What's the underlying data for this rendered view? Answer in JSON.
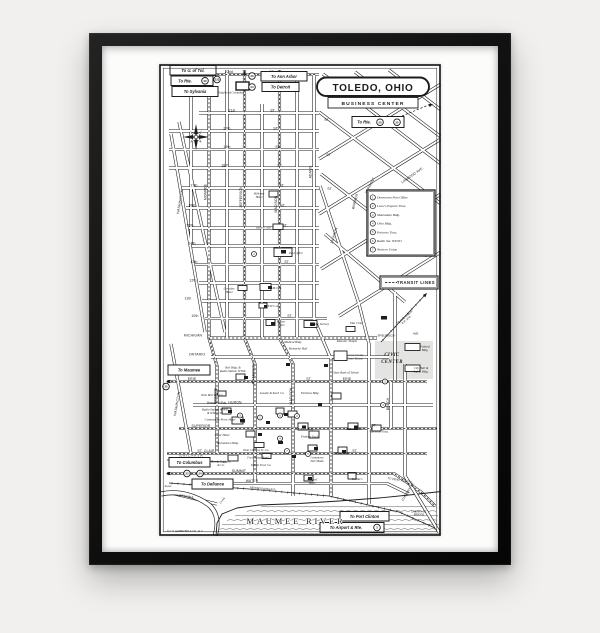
{
  "scene": {
    "background_color": "#f1f0ee",
    "frame_color": "#141414",
    "mat_color": "#fcfcfb",
    "paper_color": "#ffffff",
    "ink_color": "#1c1c1c",
    "civic_fill": "#e4e4e2"
  },
  "map": {
    "title": "TOLEDO, OHIO",
    "subtitle": "BUSINESS CENTER",
    "copyright": "© C.S. HAMMOND & CO., N.Y.",
    "river_label": "MAUMEE RIVER",
    "transit_label": "TRANSIT LINES",
    "legend": {
      "items": [
        {
          "n": "1",
          "label": "Downtown Post Office"
        },
        {
          "n": "2",
          "label": "Loew's Esquire Thea."
        },
        {
          "n": "3",
          "label": "Manhattan Bldg."
        },
        {
          "n": "4",
          "label": "Ohio Bldg."
        },
        {
          "n": "5",
          "label": "Princess Thea."
        },
        {
          "n": "6",
          "label": "Radio Sta. WTOD"
        },
        {
          "n": "7",
          "label": "Western Union"
        }
      ]
    },
    "direction_boxes": [
      {
        "label": "To U. of Tol.",
        "x": 11,
        "y": 1.5,
        "w": 46,
        "h": 9.5
      },
      {
        "label": "To Rte.",
        "x": 12,
        "y": 12,
        "w": 42,
        "h": 9.5,
        "tx": -7
      },
      {
        "label": "To Sylvania",
        "x": 13,
        "y": 22.5,
        "w": 46,
        "h": 10
      },
      {
        "label": "To Ann Arbor",
        "x": 102,
        "y": 7.5,
        "w": 46,
        "h": 9.5
      },
      {
        "label": "To Detroit",
        "x": 103,
        "y": 18.5,
        "w": 37,
        "h": 9
      },
      {
        "label": "To Rte.",
        "x": 193,
        "y": 52.5,
        "w": 52,
        "h": 11,
        "tx": -14
      },
      {
        "label": "To Maumee",
        "x": 9,
        "y": 301,
        "w": 42,
        "h": 10
      },
      {
        "label": "To Columbus",
        "x": 10,
        "y": 393.5,
        "w": 41,
        "h": 9.5
      },
      {
        "label": "To Defiance",
        "x": 33,
        "y": 415,
        "w": 41,
        "h": 10
      },
      {
        "label": "To Port Clinton",
        "x": 181,
        "y": 447.5,
        "w": 49,
        "h": 9.5
      },
      {
        "label": "To Airport & Rte.",
        "x": 161,
        "y": 458.5,
        "w": 64,
        "h": 10,
        "tx": -6
      }
    ],
    "route_shields": [
      {
        "n": "20",
        "x": 46,
        "y": 16.8
      },
      {
        "n": "223",
        "x": 58,
        "y": 15.5
      },
      {
        "n": "23",
        "x": 93,
        "y": 12
      },
      {
        "n": "24",
        "x": 93,
        "y": 23
      },
      {
        "n": "20",
        "x": 221,
        "y": 58.2
      },
      {
        "n": "25",
        "x": 238,
        "y": 58.2
      },
      {
        "n": "25",
        "x": 7,
        "y": 322.5
      },
      {
        "n": "23",
        "x": 28,
        "y": 409.5
      },
      {
        "n": "24",
        "x": 41,
        "y": 409.5
      },
      {
        "n": "2",
        "x": 218,
        "y": 463.5
      }
    ],
    "transit_stops": [
      {
        "n": "2",
        "x": 95,
        "y": 190
      },
      {
        "n": "3",
        "x": 81,
        "y": 351.5
      },
      {
        "n": "1",
        "x": 101,
        "y": 353.5
      },
      {
        "n": "6",
        "x": 121,
        "y": 351.5
      },
      {
        "n": "2",
        "x": 138,
        "y": 352
      },
      {
        "n": "4",
        "x": 121,
        "y": 374.5
      },
      {
        "n": "7",
        "x": 128,
        "y": 387
      },
      {
        "n": "5",
        "x": 149,
        "y": 390
      },
      {
        "n": "2",
        "x": 226,
        "y": 317.5
      },
      {
        "n": "3",
        "x": 224,
        "y": 341
      }
    ],
    "street_labels_horizontal": [
      {
        "t": "22nd",
        "x": 70,
        "y": 9
      },
      {
        "t": "21st",
        "x": 73,
        "y": 47.5
      },
      {
        "t": "20th",
        "x": 68,
        "y": 65.5
      },
      {
        "t": "19th",
        "x": 68,
        "y": 84
      },
      {
        "t": "18th",
        "x": 66,
        "y": 102.5
      },
      {
        "t": "17th",
        "x": 35,
        "y": 122.5
      },
      {
        "t": "16th",
        "x": 33,
        "y": 142.5
      },
      {
        "t": "15th",
        "x": 31,
        "y": 162.5
      },
      {
        "t": "14th",
        "x": 33,
        "y": 180.5
      },
      {
        "t": "13th",
        "x": 35,
        "y": 199
      },
      {
        "t": "12th",
        "x": 34,
        "y": 217.5
      },
      {
        "t": "11th",
        "x": 29,
        "y": 235.5
      },
      {
        "t": "10th",
        "x": 36,
        "y": 253
      },
      {
        "t": "MICHIGAN",
        "x": 34,
        "y": 272.5
      },
      {
        "t": "ONTARIO",
        "x": 38,
        "y": 291.5
      },
      {
        "t": "ERIE",
        "x": 33,
        "y": 316
      },
      {
        "t": "ERIE",
        "x": 188,
        "y": 316
      },
      {
        "t": "HURON",
        "x": 76,
        "y": 339.5
      },
      {
        "t": "SUPERIOR",
        "x": 42,
        "y": 363
      },
      {
        "t": "ST. CLAIR",
        "x": 47,
        "y": 388
      },
      {
        "t": "SUMMIT",
        "x": 80,
        "y": 408
      },
      {
        "t": "WATER",
        "x": 93,
        "y": 418
      },
      {
        "t": "ST.",
        "x": 113,
        "y": 9
      },
      {
        "t": "ST.",
        "x": 114,
        "y": 47.5
      },
      {
        "t": "ST.",
        "x": 117,
        "y": 65.5
      },
      {
        "t": "ST.",
        "x": 119,
        "y": 84
      },
      {
        "t": "ST.",
        "x": 121,
        "y": 102.5
      },
      {
        "t": "ST.",
        "x": 123,
        "y": 122.5
      },
      {
        "t": "ST.",
        "x": 124,
        "y": 142.5
      },
      {
        "t": "ST.",
        "x": 126,
        "y": 162.5
      },
      {
        "t": "ST.",
        "x": 128,
        "y": 199
      },
      {
        "t": "ST.",
        "x": 131,
        "y": 253
      },
      {
        "t": "ST.",
        "x": 168,
        "y": 57
      },
      {
        "t": "ST.",
        "x": 170,
        "y": 92
      },
      {
        "t": "ST.",
        "x": 171,
        "y": 126
      },
      {
        "t": "ST.",
        "x": 150,
        "y": 316
      },
      {
        "t": "ST.",
        "x": 215,
        "y": 362.5
      },
      {
        "t": "ST.",
        "x": 196,
        "y": 388
      }
    ],
    "street_labels_vertical": [
      {
        "t": "WASHINGTON",
        "x": 22,
        "y": 138,
        "r": -80
      },
      {
        "t": "MONROE",
        "x": 47.5,
        "y": 128,
        "r": -90
      },
      {
        "t": "JEFFERSON",
        "x": 83,
        "y": 133,
        "r": -90
      },
      {
        "t": "MADISON",
        "x": 118,
        "y": 140,
        "r": -90
      },
      {
        "t": "ADAMS",
        "x": 152.5,
        "y": 108,
        "r": -90
      },
      {
        "t": "JACKSON",
        "x": 176,
        "y": 172,
        "r": -72
      },
      {
        "t": "WARREN",
        "x": 197,
        "y": 138,
        "r": -75
      },
      {
        "t": "WOODRUFF",
        "x": 221,
        "y": 146,
        "r": -55
      },
      {
        "t": "VERMONT",
        "x": 212,
        "y": 122,
        "r": -62
      },
      {
        "t": "LINWOOD AVE.",
        "x": 254,
        "y": 112,
        "r": -35
      },
      {
        "t": "BEECH",
        "x": 230,
        "y": 340,
        "r": -90
      },
      {
        "t": "MONROE",
        "x": 57.5,
        "y": 332,
        "r": -90
      },
      {
        "t": "JEFFERSON",
        "x": 95.5,
        "y": 310,
        "r": -90
      },
      {
        "t": "MADISON",
        "x": 133,
        "y": 332,
        "r": -90
      },
      {
        "t": "WASHINGTON",
        "x": 19,
        "y": 340,
        "r": -80
      },
      {
        "t": "CHERRY ST.",
        "x": 250,
        "y": 428,
        "r": -58
      }
    ],
    "misc_labels": [
      {
        "t": "Knights of Columbus",
        "x": 72,
        "y": 29.5,
        "cls": "lm"
      },
      {
        "t": "TO ANN ARBOR|R.R. STA.",
        "x": 246,
        "y": 254,
        "r": -40,
        "cls": "tiny"
      },
      {
        "t": "SPIELBUSCH",
        "x": 227,
        "y": 272.5,
        "cls": "tiny"
      },
      {
        "t": "AVE.",
        "x": 257,
        "y": 270.5,
        "cls": "tiny"
      },
      {
        "t": "TO PENN. R.R. STA.",
        "x": 241,
        "y": 417,
        "r": 9,
        "cls": "tiny"
      },
      {
        "t": "TO N.Y.C. R.R. STA.",
        "x": 32,
        "y": 392.3,
        "cls": "tiny"
      },
      {
        "t": "PENNSYLVANIA R.R.",
        "x": 104,
        "y": 425.5,
        "r": 5,
        "cls": "tiny"
      },
      {
        "t": "CHERRY ST.|BRIDGE",
        "x": 260,
        "y": 448.5,
        "cls": "tiny"
      },
      {
        "t": "OTTAWA",
        "x": 27,
        "y": 433.5,
        "r": 8,
        "cls": "st"
      },
      {
        "t": "Swan",
        "x": 9,
        "y": 423,
        "cls": "lm"
      },
      {
        "t": "Creek",
        "x": 64,
        "y": 437,
        "r": -52,
        "cls": "lm"
      },
      {
        "t": "&",
        "x": 229,
        "y": 59.8,
        "cls": "bx"
      }
    ],
    "landmarks": [
      {
        "t": "Hillcrest|Hotel",
        "x": 100,
        "y": 130.5
      },
      {
        "t": "Toledo Club",
        "x": 104,
        "y": 164.5
      },
      {
        "t": "Post Office",
        "x": 137,
        "y": 190
      },
      {
        "t": "Lorraine|Hotel",
        "x": 70,
        "y": 225.5
      },
      {
        "t": "Y.M.C.A.",
        "x": 117,
        "y": 225
      },
      {
        "t": "Y.W.C.A.",
        "x": 114,
        "y": 243
      },
      {
        "t": "Milner|Hotel",
        "x": 122,
        "y": 258.5
      },
      {
        "t": "Public Library",
        "x": 161,
        "y": 261
      },
      {
        "t": "Elks Club",
        "x": 197,
        "y": 260
      },
      {
        "t": "Medical Bldg.",
        "x": 134,
        "y": 279
      },
      {
        "t": "Memorial Hall",
        "x": 139,
        "y": 285.5
      },
      {
        "t": "Masonic Temple",
        "x": 188,
        "y": 278
      },
      {
        "t": "Lucas County|Court House",
        "x": 196,
        "y": 292
      },
      {
        "t": "Federal|Bldg.",
        "x": 266,
        "y": 283.5
      },
      {
        "t": "City Hall &|Safety Bldg.",
        "x": 262,
        "y": 305
      },
      {
        "t": "State Bank of Toledo",
        "x": 187,
        "y": 309.5
      },
      {
        "t": "Bell Bldg. &|Radio Station WTOL",
        "x": 74,
        "y": 304.5
      },
      {
        "t": "Ohio Bell Tel. Co.",
        "x": 53,
        "y": 332
      },
      {
        "t": "Broadcast Bldg.",
        "x": 58,
        "y": 339.5
      },
      {
        "t": "Radio Station WSPD|& WSPD-TV",
        "x": 56,
        "y": 346.5
      },
      {
        "t": "Commodore Perry Hotel",
        "x": 61,
        "y": 356.5
      },
      {
        "t": "Lasalle & Koch Co.",
        "x": 113,
        "y": 330
      },
      {
        "t": "Nicholas Bldg.",
        "x": 151,
        "y": 330
      },
      {
        "t": "Secor Hotel",
        "x": 63,
        "y": 372
      },
      {
        "t": "Richardson Bldg.",
        "x": 69,
        "y": 380
      },
      {
        "t": "Ohio Citizens Tr. Co.",
        "x": 97,
        "y": 387
      },
      {
        "t": "Fort Meigs Hotel",
        "x": 99,
        "y": 394.5
      },
      {
        "t": "Toledo Trust Co.",
        "x": 102,
        "y": 402
      },
      {
        "t": "Sears, Roebuck|& Co.",
        "x": 62,
        "y": 398.5
      },
      {
        "t": "Edison Bldg.",
        "x": 147,
        "y": 366
      },
      {
        "t": "Produce Exch.",
        "x": 151,
        "y": 373.5
      },
      {
        "t": "Commerce|Nat'l Bank",
        "x": 158,
        "y": 394.5
      },
      {
        "t": "Palace Thea.",
        "x": 183,
        "y": 390
      },
      {
        "t": "Willard Hotel",
        "x": 195,
        "y": 366
      },
      {
        "t": "Valentine Thea.",
        "x": 220,
        "y": 368.5
      },
      {
        "t": "Waldorf|Hotel",
        "x": 153,
        "y": 416.5
      },
      {
        "t": "Tiedtke's",
        "x": 198,
        "y": 416
      },
      {
        "t": "CIVIC|CENTER",
        "x": 233,
        "y": 292,
        "cls": "civic",
        "dy": 7
      }
    ]
  }
}
